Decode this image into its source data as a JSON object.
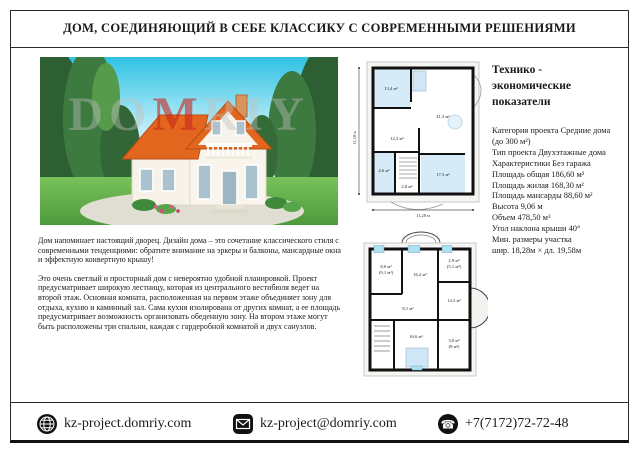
{
  "title": "ДОМ, СОЕДИНЯЮЩИЙ В СЕБЕ КЛАССИКУ С СОВРЕМЕННЫМИ РЕШЕНИЯМИ",
  "photo": {
    "watermark": {
      "prefix": "DO",
      "accent": "M",
      "suffix": "RIY"
    }
  },
  "description": {
    "paragraph1": "Дом напоминает настоящий дворец. Дизайн дома – это сочетание классического стиля с современными тенденциями: обратите внимание на эркеры и балконы, мансардные окна и эффектную конвертную крышу!",
    "paragraph2": "Это очень светлый и просторный дом с невероятно удобной планировкой. Проект предусматривает широкую лестницу, которая из центрального вестибюля ведет на второй этаж. Основная комната, расположенная на первом этаже объединяет зону для отдыха, кухню и каминный зал. Сама кухня изолирована от других комнат, а ее площадь предусматривает возможность организовать обеденную зону. На втором этаже могут быть расположены  три спальни, каждая с гардеробной комнатой и двух санузлов."
  },
  "plans": {
    "floor1": {
      "rooms": [
        "13,4 м²",
        "41,3 м²",
        "12,3 м²",
        "4,6 м²",
        "2,8 м²",
        "17,3 м²"
      ],
      "width_label": "11,28 м",
      "height_label": "11,58 м"
    },
    "floor2": {
      "rooms": [
        "8,0 м²",
        "(9,1 м²)",
        "16,2 м²",
        "2,9 м²",
        "(5,1 м²)",
        "14,3 м²",
        "8,1 м²",
        "16,6 м²",
        "3,0 м²",
        "(8 м²)"
      ]
    }
  },
  "specs": {
    "heading": "Технико - экономические показатели",
    "items": [
      "Категория проекта Средние дома",
      "(до 300 м²)",
      "Тип проекта Двухэтажные дома",
      "Характеристики  Без гаража",
      "Площадь общая   186,60 м²",
      "Площадь жилая   168,30 м²",
      "Площадь мансарды   88,60 м²",
      "Высота   9,06 м",
      "Объем 478,50 м³",
      "Угол наклона крыши 40°",
      "Мин. размеры участка",
      "шир. 18,28м × дл. 19,58м"
    ]
  },
  "footer": {
    "website": "kz-project.domriy.com",
    "email": "kz-project@domriy.com",
    "phone": "+7(7172)72-72-48"
  },
  "icons": {
    "website": "globe",
    "email": "envelope",
    "phone_glyph": "☎"
  },
  "colors": {
    "roof": "#e2661d",
    "plan_room_blue": "#d6ebf8",
    "watermark_accent": "#c92620"
  }
}
